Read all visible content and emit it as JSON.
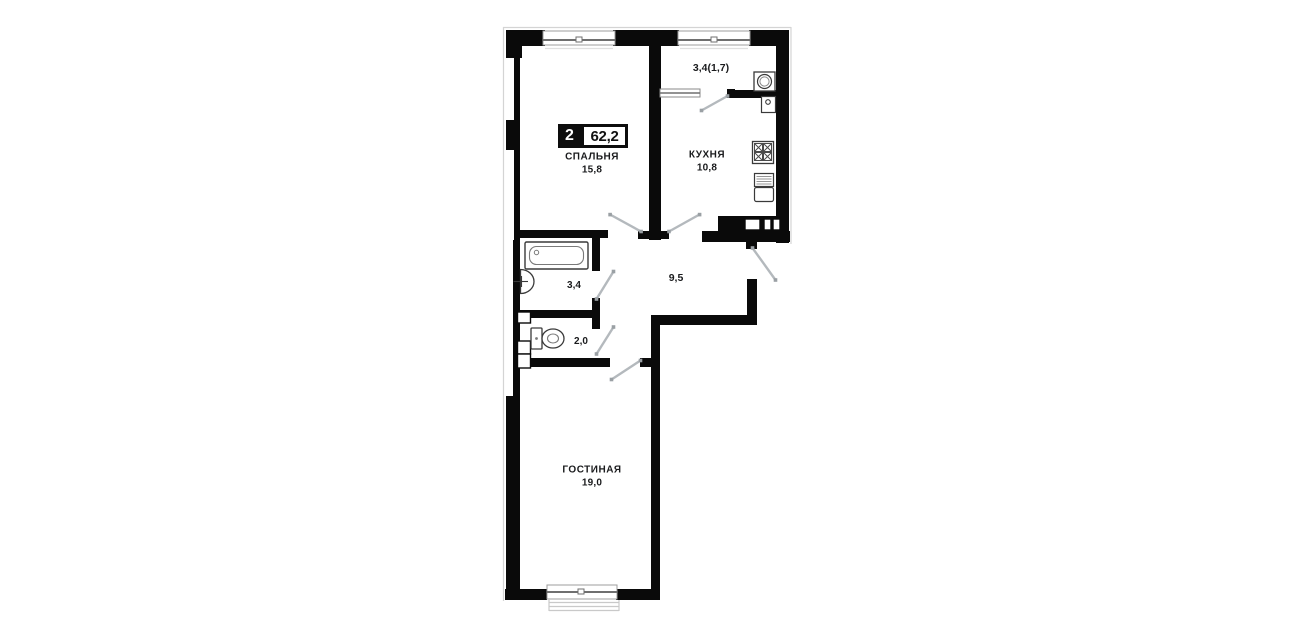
{
  "badge": {
    "rooms": "2",
    "total_area": "62,2"
  },
  "rooms": {
    "bedroom": {
      "name": "СПАЛЬНЯ",
      "area": "15,8"
    },
    "kitchen": {
      "name": "КУХНЯ",
      "area": "10,8"
    },
    "living_room": {
      "name": "ГОСТИНАЯ",
      "area": "19,0"
    },
    "loggia": {
      "area": "3,4(1,7)"
    },
    "hallway": {
      "area": "9,5"
    },
    "bathroom": {
      "area": "3,4"
    },
    "toilet": {
      "area": "2,0"
    }
  },
  "fixtures": [
    "bathtub-icon",
    "bathroom-sink-icon",
    "toilet-icon",
    "stove-icon",
    "kitchen-sink-icon",
    "washing-machine-icon",
    "water-heater-icon"
  ],
  "colors": {
    "wall": "#0a0a0a",
    "door_swing": "#b4b9bd",
    "label_text": "#1a1b1d",
    "background": "#ffffff"
  }
}
